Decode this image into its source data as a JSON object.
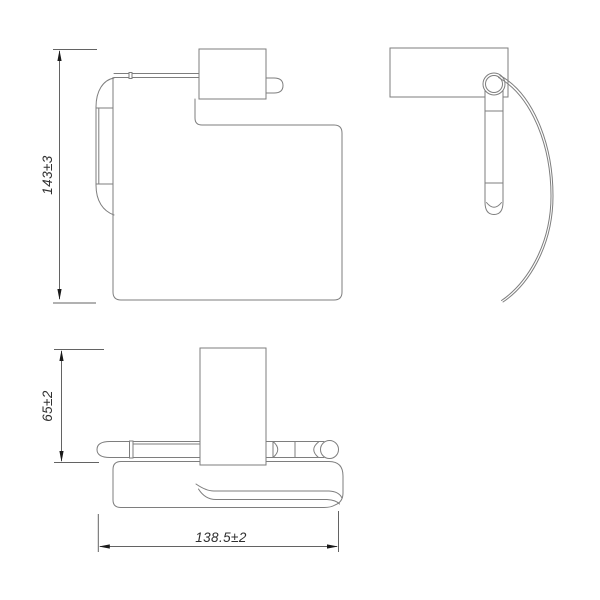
{
  "drawing": {
    "type": "orthographic-technical-drawing",
    "part": "toilet-roll-holder-with-cover",
    "views": {
      "front": {
        "height_dimension": {
          "label": "143±3"
        }
      },
      "top": {
        "depth_dimension": {
          "label": "65±2"
        },
        "width_dimension": {
          "label": "138.5±2"
        }
      }
    },
    "colors": {
      "object_line": "#7e7e7e",
      "dimension_line": "#636363",
      "arrow": "#1a1a1a",
      "text": "#2f2f2f",
      "background": "#ffffff"
    }
  }
}
